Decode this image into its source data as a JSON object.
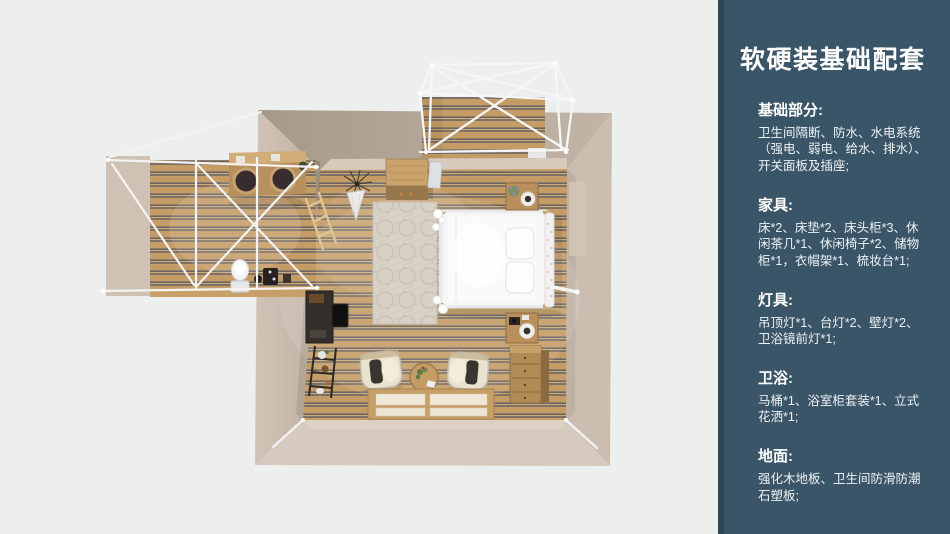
{
  "page": {
    "width": 950,
    "height": 534,
    "background": "#edefee"
  },
  "sidebar": {
    "background": "#3a5568",
    "edge_color": "#2f4558",
    "text_color": "#ffffff",
    "title": "软硬装基础配套",
    "sections": [
      {
        "heading": "基础部分:",
        "body": "卫生间隔断、防水、水电系统\n（强电、弱电、给水、排水）、\n开关面板及插座;"
      },
      {
        "heading": "家具:",
        "body": "床*2、床垫*2、床头柜*3、休\n闲茶几*1、休闲椅子*2、储物\n柜*1，衣帽架*1、梳妆台*1;"
      },
      {
        "heading": "灯具:",
        "body": "吊顶灯*1、台灯*2、壁灯*2、\n卫浴镜前灯*1;"
      },
      {
        "heading": "卫浴:",
        "body": "马桶*1、浴室柜套装*1、立式\n花洒*1;"
      },
      {
        "heading": "地面:",
        "body": "强化木地板、卫生间防滑防潮\n石塑板;"
      }
    ]
  },
  "floorplan": {
    "view": "top-down 3D render",
    "rooms": [
      "bedroom",
      "bathroom",
      "porch"
    ],
    "colors": {
      "wall_beige": "#c9bcaf",
      "wall_top_shadow": "#a99d91",
      "wall_bottom_lit": "#d6c9bd",
      "floor_wood": "#c59c65",
      "floor_slat_line": "#5b5d66",
      "frame_white": "#f5f5f3",
      "rug": "#d7d0c5",
      "furniture_wood": "#b18854",
      "dark_furniture": "#35302c",
      "bed_white": "#fafafc"
    },
    "items": [
      "pergola-frame",
      "porch-deck",
      "double-bed",
      "pillows",
      "ruffled-duvet",
      "rug",
      "nightstand-top",
      "nightstand-bottom",
      "dresser",
      "storage-cabinet",
      "dried-plant",
      "leaning-mirror",
      "desk",
      "tv",
      "ladder",
      "shelf-rack",
      "armchair-left",
      "armchair-right",
      "coffee-table",
      "tatami-platform",
      "bathroom-frame",
      "double-sink-counter",
      "toilet",
      "shower-set",
      "towel-rail"
    ]
  }
}
